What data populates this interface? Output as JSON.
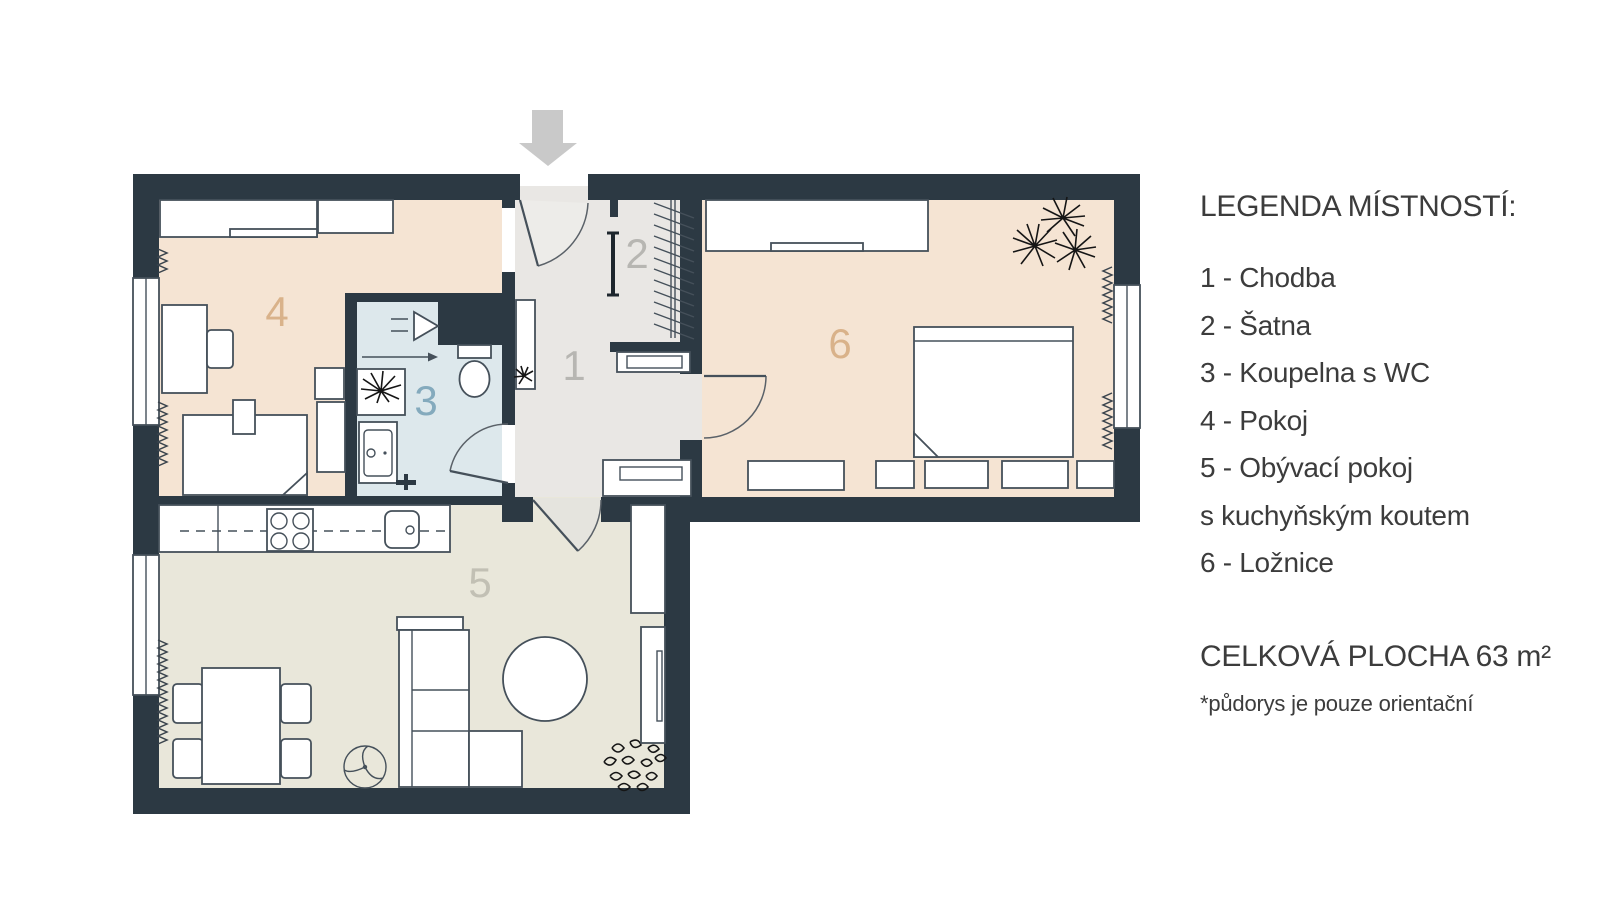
{
  "legend": {
    "heading": "LEGENDA MÍSTNOSTÍ:",
    "lines": [
      "1 - Chodba",
      "2 - Šatna",
      "3 - Koupelna s WC",
      "4 - Pokoj",
      "5 - Obývací pokoj",
      "s kuchyňským koutem",
      "6 - Ložnice"
    ]
  },
  "summary": {
    "total_area": "CELKOVÁ PLOCHA 63 m²",
    "disclaimer": "*půdorys je pouze orientační"
  },
  "plan": {
    "wall_color": "#2c3943",
    "entrance_arrow_color": "#c9c9c9",
    "rooms": [
      {
        "number": "1",
        "name": "Chodba",
        "floor_color": "#e9e7e4",
        "label_color": "#b7b6b2"
      },
      {
        "number": "2",
        "name": "Šatna",
        "floor_color": "#e9e7e4",
        "label_color": "#b7b6b2"
      },
      {
        "number": "3",
        "name": "Koupelna s WC",
        "floor_color": "#dde8ec",
        "label_color": "#84aabd"
      },
      {
        "number": "4",
        "name": "Pokoj",
        "floor_color": "#f5e4d3",
        "label_color": "#d9b28a"
      },
      {
        "number": "5",
        "name": "Obývací pokoj s kuchyňským koutem",
        "floor_color": "#e9e7da",
        "label_color": "#c2c0b4"
      },
      {
        "number": "6",
        "name": "Ložnice",
        "floor_color": "#f5e4d3",
        "label_color": "#d9b28a"
      }
    ]
  }
}
